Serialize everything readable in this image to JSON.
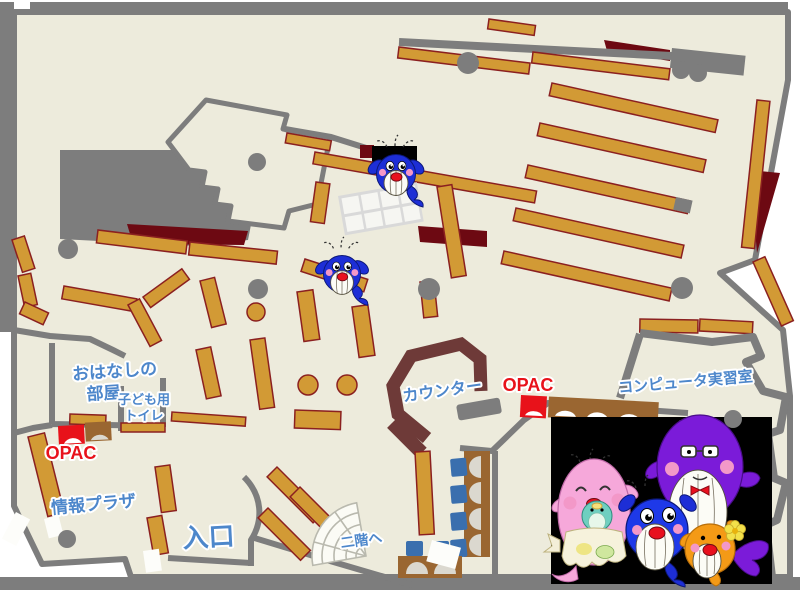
{
  "page": {
    "type": "library-floor-map",
    "floor": "1F"
  },
  "labels": {
    "storytelling_room_line1": "おはなしの",
    "storytelling_room_line2": "部屋",
    "kids_toilet_line1": "子ども用",
    "kids_toilet_line2": "トイレ",
    "opac_left": "OPAC",
    "opac_right": "OPAC",
    "info_plaza": "情報プラザ",
    "entrance": "入口",
    "counter": "カウンター",
    "to_second_floor": "二階へ",
    "computer_room": "コンピュータ実習室"
  },
  "icons": {
    "map_mascot": "blue-whale-mascot",
    "family_illustration": "whale-family-mascots",
    "opac_terminal": "opac-terminal-marker",
    "stairs": "stairs-fan"
  },
  "colors": {
    "floor": "#edebdc",
    "wall": "#7d7d7d",
    "shelf": "#d29a35",
    "shelf_border": "#8b2020",
    "counter": "#6e3a38",
    "desk": "#9a6631",
    "chair": "#3a6fae",
    "label_blue": "#4d87cb",
    "opac_red": "#e8121a",
    "dark_red": "#6d0912",
    "photo_background": "#000000"
  }
}
